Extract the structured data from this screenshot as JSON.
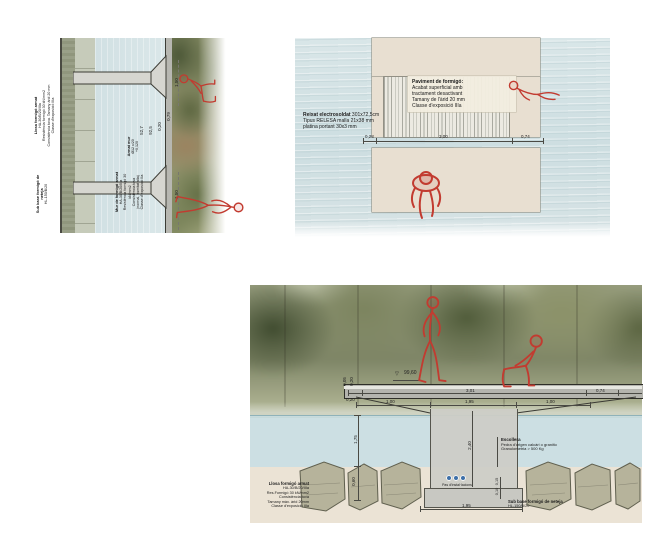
{
  "colors": {
    "figure_red": "#c23b30",
    "water_blue": "#cfe0e3",
    "concrete_plan_beige": "#e8dfd1",
    "concrete_section_grey": "#c8c8c2",
    "riprap_rock": "#b6b39b",
    "conduit_blue": "#3d6fa8"
  },
  "icons": {
    "level_marker": "▽"
  },
  "panelA": {
    "llosa_block": {
      "title": "Llosa formigó armat",
      "lines": [
        "HA-30/B/20/IIIa",
        "Resistència formigó 30 kN/mm2",
        "Consistència tova. Tamany àrid 20 mm",
        "Classe d'exposició IIIa"
      ]
    },
    "subbase_block": {
      "title": "Sub base formigó de neteja",
      "line": "HL-150/B/20"
    },
    "armat_block": {
      "lines": [
        "Armat mur",
        "Ø12 c/20",
        "+0,120"
      ]
    },
    "mur_block": {
      "title": "Mur de formigó armat",
      "lines": [
        "HA-30/B/20/IIIa",
        "Resistència formigó 30 kN/mm2",
        "Consistència tova",
        "(normal, humitat alta)",
        "Classe d'exposició IIa"
      ]
    },
    "dims": [
      "1,50",
      "0,79",
      "0,20",
      "92,5",
      "52,7",
      "1,50"
    ]
  },
  "panelB": {
    "paviment_block": {
      "title": "Paviment de formigó:",
      "lines": [
        "Acabat superficial amb",
        "tractament desactivant",
        "Tamany de l'àrid 20 mm",
        "Classe d'exposició IIIa"
      ]
    },
    "reixat_block": {
      "title": "Reixat electrosoldat",
      "title_rest": " 301x72,5cm",
      "lines": [
        "Tipus RELESA malla 21x38 mm",
        "platina portant 30x3 mm"
      ]
    },
    "dims": {
      "left": "0,28",
      "mid": "3,00",
      "right": "0,74"
    }
  },
  "panelC": {
    "level": "99,60",
    "deck_dims": {
      "left": "0,20",
      "mid": "3,01",
      "right": "0,74"
    },
    "lower_dims": {
      "left": "1,00",
      "mid": "1,95",
      "right": "1,00"
    },
    "pier_height": "2,40",
    "left_dims": {
      "deck_a": "0,05",
      "deck_b": "0,20",
      "water": "1,75",
      "rock": "0,60"
    },
    "right_dims": {
      "a": "0,15",
      "b": "0,10"
    },
    "footing_dim": "1,95",
    "escollera_block": {
      "title": "Escollera",
      "lines": [
        "Pedra d'origen calcàri o granític",
        "Granulometria > 500 Kg"
      ]
    },
    "llosa_block": {
      "title": "Llosa formigó armat",
      "lines": [
        "HA-30/B/20/IIIa",
        "Res.Formigó 30 kN/mm2",
        "Consistència tova",
        "Tamany màx. àrid 20mm",
        "Classe d'exposició IIIa"
      ]
    },
    "subbase_block": {
      "title": "Sub base formigó de neteja",
      "line": "HL-150/B/20"
    },
    "pas_label": "Pas d'instal·lacions"
  }
}
